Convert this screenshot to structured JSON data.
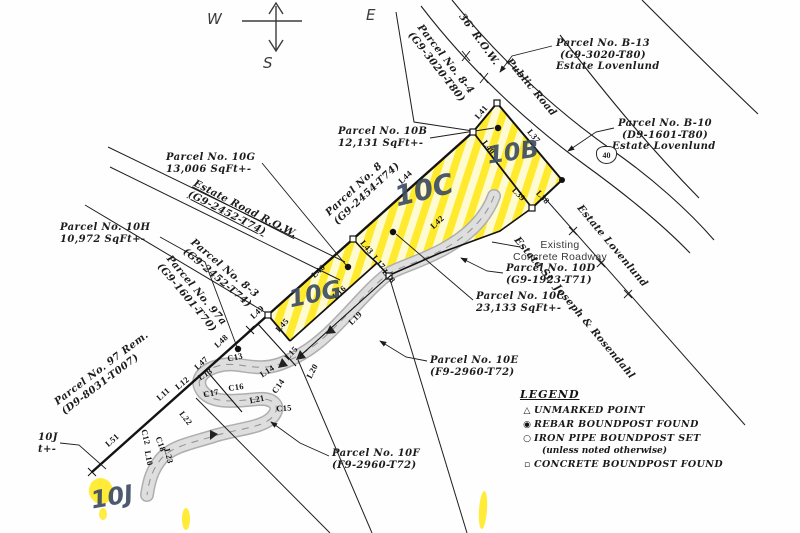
{
  "compass": {
    "west": "W",
    "east": "E",
    "south": "S"
  },
  "labels": {
    "p10b": [
      "Parcel No. 10B",
      "12,131 SqFt+-"
    ],
    "p10c": [
      "Parcel No. 10C",
      "23,133 SqFt+-"
    ],
    "p10g": [
      "Parcel No. 10G",
      "13,006 SqFt+-"
    ],
    "p10h": [
      "Parcel No. 10H",
      "10,972 SqFt+-"
    ],
    "p10d": [
      "Parcel No. 10D",
      "(G9-1923-T71)"
    ],
    "p10e": [
      "Parcel No. 10E",
      "(F9-2960-T72)"
    ],
    "p10f": [
      "Parcel No. 10F",
      "(F9-2960-T72)"
    ],
    "p10j": [
      "10J",
      "t+-"
    ],
    "pb13": [
      "Parcel No. B-13",
      "(G9-3020-T80)",
      "Estate Lovenlund"
    ],
    "pb10": [
      "Parcel No. B-10",
      "(D9-1601-T80)",
      "Estate Lovenlund"
    ],
    "p84": [
      "Parcel No. 8-4",
      "(G9-3020-T80)"
    ],
    "p8": [
      "Parcel No. 8",
      "(G9-2454-T74)"
    ],
    "estrd": [
      "Estate Road R.O.W.",
      "(G9-2452-T74)"
    ],
    "p83": [
      "Parcel No. 8-3",
      "(G9-2452-T74)"
    ],
    "p97a": [
      "Parcel No. 97a",
      "(G9-1601-T70)"
    ],
    "p97rem": [
      "Parcel No. 97 Rem.",
      "(D9-8031-T007)"
    ],
    "road36a": "36' R.O.W.",
    "road36b": "Public Road",
    "ecr": [
      "Existing",
      "Concrete Roadway"
    ],
    "est_stjoseph": "Estate St. Joseph & Rosendahl",
    "est_lovenlund": "Estate Lovenlund",
    "route40": "40"
  },
  "line_labels": [
    {
      "t": "L41",
      "x": 481,
      "y": 112,
      "r": -50
    },
    {
      "t": "L37",
      "x": 534,
      "y": 136,
      "r": 50
    },
    {
      "t": "L40",
      "x": 489,
      "y": 147,
      "r": 52
    },
    {
      "t": "L39",
      "x": 519,
      "y": 194,
      "r": 46
    },
    {
      "t": "L38",
      "x": 543,
      "y": 197,
      "r": 46
    },
    {
      "t": "L44",
      "x": 405,
      "y": 177,
      "r": -43
    },
    {
      "t": "L42",
      "x": 437,
      "y": 222,
      "r": -43
    },
    {
      "t": "L43",
      "x": 367,
      "y": 247,
      "r": 50
    },
    {
      "t": "L17",
      "x": 379,
      "y": 262,
      "r": 50
    },
    {
      "t": "L18",
      "x": 389,
      "y": 276,
      "r": 50
    },
    {
      "t": "L46",
      "x": 318,
      "y": 271,
      "r": -43
    },
    {
      "t": "L16",
      "x": 339,
      "y": 292,
      "r": -43
    },
    {
      "t": "L45",
      "x": 282,
      "y": 325,
      "r": -48
    },
    {
      "t": "L19",
      "x": 355,
      "y": 318,
      "r": -45
    },
    {
      "t": "L49",
      "x": 257,
      "y": 312,
      "r": -43
    },
    {
      "t": "L48",
      "x": 221,
      "y": 341,
      "r": -43
    },
    {
      "t": "L47",
      "x": 201,
      "y": 363,
      "r": -43
    },
    {
      "t": "L13",
      "x": 205,
      "y": 374,
      "r": -33
    },
    {
      "t": "L12",
      "x": 182,
      "y": 383,
      "r": -40
    },
    {
      "t": "L11",
      "x": 163,
      "y": 394,
      "r": -42
    },
    {
      "t": "L51",
      "x": 112,
      "y": 440,
      "r": -42
    },
    {
      "t": "C13",
      "x": 235,
      "y": 357,
      "r": -12
    },
    {
      "t": "L14",
      "x": 267,
      "y": 371,
      "r": -33
    },
    {
      "t": "C14",
      "x": 278,
      "y": 386,
      "r": -55
    },
    {
      "t": "C16",
      "x": 236,
      "y": 387,
      "r": -8
    },
    {
      "t": "C17",
      "x": 211,
      "y": 393,
      "r": -12
    },
    {
      "t": "L21",
      "x": 257,
      "y": 399,
      "r": -12
    },
    {
      "t": "C15",
      "x": 284,
      "y": 408,
      "r": -4
    },
    {
      "t": "L22",
      "x": 186,
      "y": 418,
      "r": 52
    },
    {
      "t": "C12",
      "x": 146,
      "y": 437,
      "r": 76
    },
    {
      "t": "C18",
      "x": 161,
      "y": 444,
      "r": 70
    },
    {
      "t": "L10",
      "x": 149,
      "y": 458,
      "r": 80
    },
    {
      "t": "L23",
      "x": 169,
      "y": 456,
      "r": 76
    },
    {
      "t": "L15",
      "x": 291,
      "y": 353,
      "r": -48
    },
    {
      "t": "L20",
      "x": 312,
      "y": 371,
      "r": -62
    }
  ],
  "handwritten": [
    {
      "t": "10B",
      "x": 513,
      "y": 152,
      "r": -8,
      "s": 24
    },
    {
      "t": "10C",
      "x": 424,
      "y": 190,
      "r": -14,
      "s": 28
    },
    {
      "t": "10G",
      "x": 315,
      "y": 294,
      "r": -12,
      "s": 24
    },
    {
      "t": "10J",
      "x": 112,
      "y": 497,
      "r": -10,
      "s": 24
    }
  ],
  "legend": {
    "title": "LEGEND",
    "items": [
      {
        "sym": "△",
        "text": "UNMARKED POINT"
      },
      {
        "sym": "◉",
        "text": "REBAR BOUNDPOST FOUND"
      },
      {
        "sym": "○",
        "text": "IRON PIPE BOUNDPOST SET"
      },
      {
        "sym": "▫",
        "text": "CONCRETE BOUNDPOST FOUND"
      }
    ],
    "subnote": "(unless noted otherwise)"
  }
}
